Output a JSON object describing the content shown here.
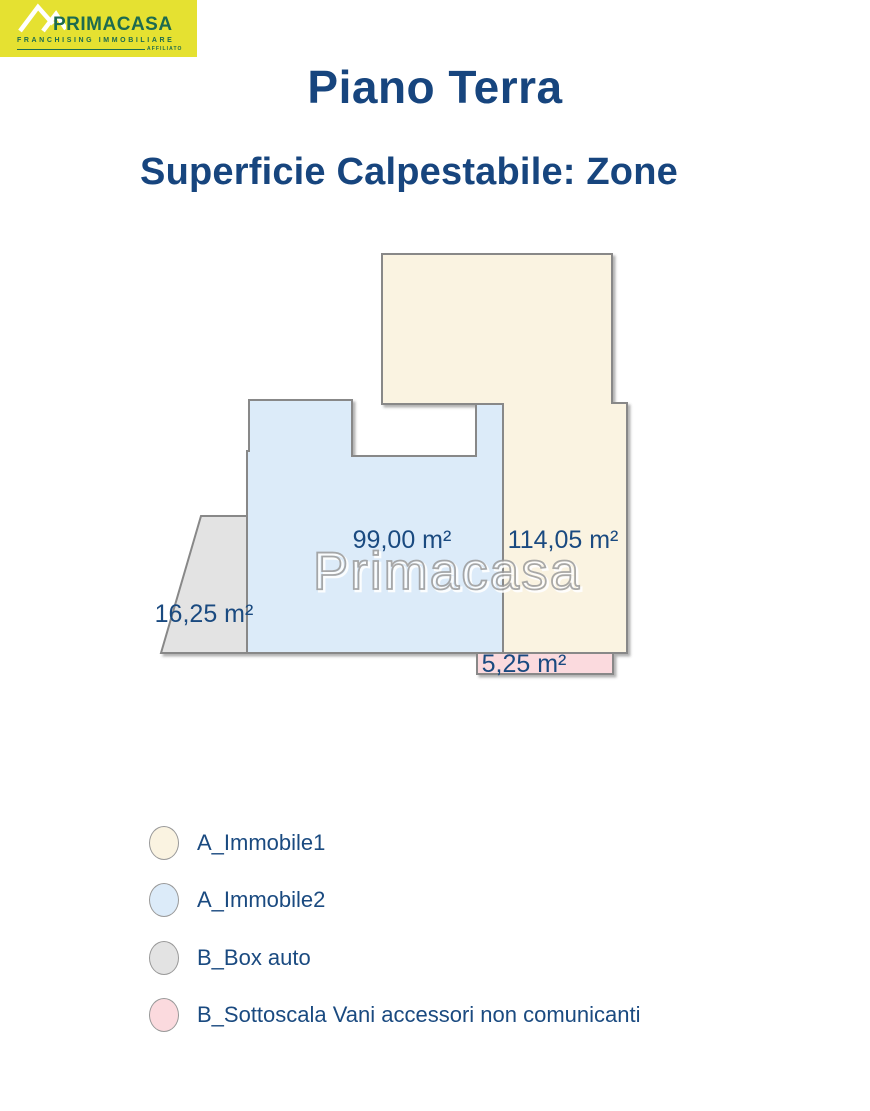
{
  "logo": {
    "brand": "PRIMACASA",
    "tagline": "FRANCHISING IMMOBILIARE",
    "affiliate": "AFFILIATO",
    "bg_color": "#e5e131",
    "text_color": "#1d6b4f"
  },
  "header": {
    "title": "Piano Terra",
    "subtitle": "Superficie Calpestabile: Zone"
  },
  "watermark": "Primacasa",
  "theme": {
    "title_color": "#17457e",
    "label_color": "#1a4a80",
    "border_color": "#888888",
    "watermark_color": "#9b9b9b"
  },
  "plan": {
    "zones": [
      {
        "id": "immobile1",
        "label": "A_Immobile1",
        "area": "114,05 m²",
        "color": "#faf3e1"
      },
      {
        "id": "immobile2",
        "label": "A_Immobile2",
        "area": "99,00 m²",
        "color": "#dcebf9"
      },
      {
        "id": "box-auto",
        "label": "B_Box auto",
        "area": "16,25 m²",
        "color": "#e3e3e3"
      },
      {
        "id": "sottoscala",
        "label": "B_Sottoscala Vani accessori non comunicanti",
        "area": "5,25 m²",
        "color": "#fbdade"
      }
    ]
  }
}
